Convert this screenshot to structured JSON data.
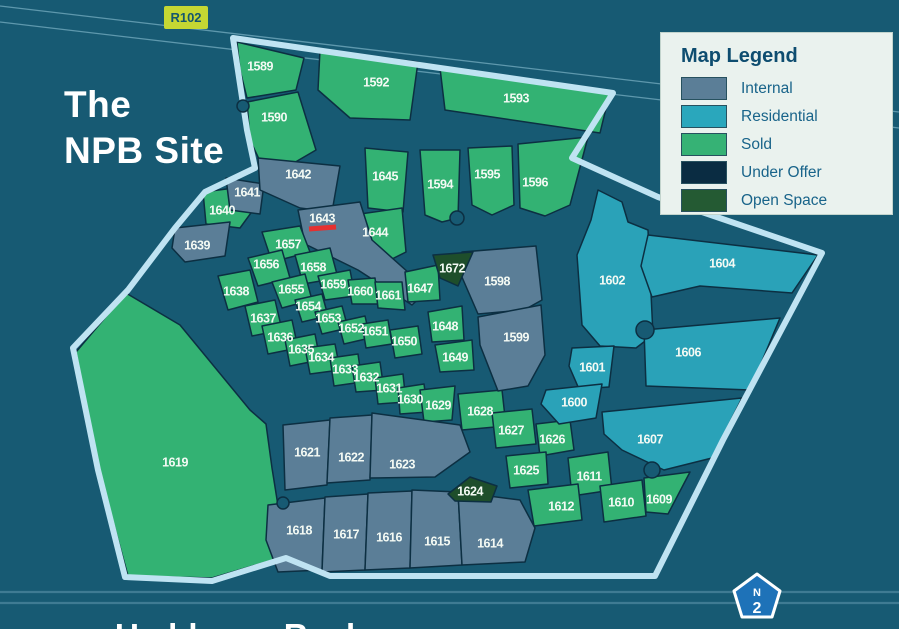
{
  "title": {
    "line1": "The",
    "line2": "NPB Site"
  },
  "badges": {
    "r102": "R102",
    "n2_letter": "N",
    "n2_number": "2"
  },
  "legend": {
    "title": "Map Legend",
    "items": [
      {
        "label": "Internal",
        "status": "internal",
        "color": "#5b7e97"
      },
      {
        "label": "Residential",
        "status": "residential",
        "color": "#2aa7bc"
      },
      {
        "label": "Sold",
        "status": "sold",
        "color": "#36b275"
      },
      {
        "label": "Under Offer",
        "status": "under_offer",
        "color": "#0a2c42"
      },
      {
        "label": "Open Space",
        "status": "open_space",
        "color": "#245a33"
      }
    ]
  },
  "bottom_partial_label": "Umhlanga Rocks",
  "colors": {
    "background": "#175a73",
    "plot_outline": "#0c2f42",
    "boundary": "#bfe3f2",
    "label_text": "#f4faf4",
    "thin_road_line": "#5e98ad",
    "highway_line": "#3f7b93",
    "red_marker": "#e53030",
    "legend_bg": "#eaf2ee",
    "r102_bg": "#c5d733",
    "r102_text": "#14566e",
    "n2_fill": "#1e72b8"
  },
  "status_colors": {
    "internal": "#5b7e97",
    "residential": "#2aa2b8",
    "sold": "#33b273",
    "under_offer": "#0a2c42",
    "open_space": "#1e4e2b"
  },
  "map": {
    "boundary_points": "233,38 613,93 572,158 658,197 822,253 723,440 655,576 330,576 286,558 212,581 125,577 98,470 73,348 128,290 175,228 205,192 255,168 247,130",
    "diagonal_road_lines": [
      [
        0,
        6,
        899,
        112
      ],
      [
        0,
        22,
        899,
        128
      ]
    ],
    "highway_lines": [
      [
        0,
        592,
        899,
        592
      ],
      [
        0,
        603,
        899,
        603
      ]
    ],
    "cul_de_sacs": [
      [
        243,
        106,
        6
      ],
      [
        457,
        218,
        7
      ],
      [
        645,
        330,
        9
      ],
      [
        652,
        470,
        8
      ],
      [
        283,
        503,
        6
      ]
    ],
    "red_marker": {
      "x1": 309,
      "y1": 229,
      "x2": 336,
      "y2": 227
    },
    "plots": [
      {
        "id": "1589",
        "status": "sold",
        "points": "237,42 304,58 296,90 247,98 240,70",
        "lx": 260,
        "ly": 66
      },
      {
        "id": "1590",
        "status": "sold",
        "points": "247,102 298,92 316,150 268,178 250,140",
        "lx": 274,
        "ly": 117
      },
      {
        "id": "1592",
        "status": "sold",
        "points": "320,50 418,62 410,120 350,118 318,90",
        "lx": 376,
        "ly": 82
      },
      {
        "id": "1593",
        "status": "sold",
        "points": "440,68 610,92 600,133 445,110",
        "lx": 516,
        "ly": 98
      },
      {
        "id": "1594",
        "status": "sold",
        "points": "420,150 460,150 458,218 442,222 425,215",
        "lx": 440,
        "ly": 184
      },
      {
        "id": "1595",
        "status": "sold",
        "points": "468,148 512,146 514,205 492,215 472,205",
        "lx": 487,
        "ly": 174
      },
      {
        "id": "1596",
        "status": "sold",
        "points": "518,144 588,137 570,205 545,216 520,208",
        "lx": 535,
        "ly": 182
      },
      {
        "id": "1645",
        "status": "sold",
        "points": "365,148 408,152 403,212 368,208",
        "lx": 385,
        "ly": 176
      },
      {
        "id": "1644",
        "status": "sold",
        "points": "360,214 402,208 406,252 386,262 362,250",
        "lx": 375,
        "ly": 232
      },
      {
        "id": "1640",
        "status": "sold",
        "points": "203,192 250,186 256,206 240,228 206,224",
        "lx": 222,
        "ly": 210
      },
      {
        "id": "1641",
        "status": "internal",
        "points": "226,178 264,184 260,214 230,210",
        "lx": 247,
        "ly": 192
      },
      {
        "id": "1642",
        "status": "internal",
        "points": "258,158 340,166 332,212 300,208 260,190",
        "lx": 298,
        "ly": 174
      },
      {
        "id": "1643",
        "status": "internal",
        "points": "298,210 360,202 372,240 428,290 412,305 358,270 305,244",
        "lx": 322,
        "ly": 218
      },
      {
        "id": "1639",
        "status": "internal",
        "points": "175,228 230,222 225,256 185,262 172,248",
        "lx": 197,
        "ly": 245
      },
      {
        "id": "1657",
        "status": "sold",
        "points": "262,232 300,226 310,252 272,262",
        "lx": 288,
        "ly": 244
      },
      {
        "id": "1656",
        "status": "sold",
        "points": "248,258 282,250 290,278 258,286",
        "lx": 266,
        "ly": 264
      },
      {
        "id": "1658",
        "status": "sold",
        "points": "295,255 330,248 338,278 303,284",
        "lx": 313,
        "ly": 267
      },
      {
        "id": "1655",
        "status": "sold",
        "points": "272,282 305,274 312,300 282,308",
        "lx": 291,
        "ly": 289
      },
      {
        "id": "1659",
        "status": "sold",
        "points": "318,276 350,270 355,296 325,300",
        "lx": 333,
        "ly": 284
      },
      {
        "id": "1660",
        "status": "sold",
        "points": "348,280 375,278 378,304 352,304",
        "lx": 360,
        "ly": 291
      },
      {
        "id": "1661",
        "status": "sold",
        "points": "375,282 402,282 405,310 378,308",
        "lx": 388,
        "ly": 295
      },
      {
        "id": "1647",
        "status": "sold",
        "points": "405,272 438,265 440,300 408,302",
        "lx": 420,
        "ly": 288
      },
      {
        "id": "1654",
        "status": "sold",
        "points": "295,300 322,294 328,316 302,322",
        "lx": 308,
        "ly": 306
      },
      {
        "id": "1653",
        "status": "sold",
        "points": "315,312 342,306 348,328 322,334",
        "lx": 328,
        "ly": 318
      },
      {
        "id": "1652",
        "status": "sold",
        "points": "338,322 365,316 370,338 344,344",
        "lx": 351,
        "ly": 328
      },
      {
        "id": "1651",
        "status": "sold",
        "points": "362,324 388,320 392,344 366,348",
        "lx": 375,
        "ly": 331
      },
      {
        "id": "1650",
        "status": "sold",
        "points": "390,330 418,326 422,354 395,358",
        "lx": 404,
        "ly": 341
      },
      {
        "id": "1648",
        "status": "sold",
        "points": "428,312 462,306 464,340 432,342",
        "lx": 445,
        "ly": 326
      },
      {
        "id": "1649",
        "status": "sold",
        "points": "435,345 472,340 474,370 440,372",
        "lx": 455,
        "ly": 357
      },
      {
        "id": "1638",
        "status": "sold",
        "points": "218,276 250,270 258,302 228,310",
        "lx": 236,
        "ly": 291
      },
      {
        "id": "1637",
        "status": "sold",
        "points": "245,306 275,300 282,330 252,336",
        "lx": 263,
        "ly": 318
      },
      {
        "id": "1636",
        "status": "sold",
        "points": "262,326 292,320 298,348 268,354",
        "lx": 280,
        "ly": 337
      },
      {
        "id": "1635",
        "status": "sold",
        "points": "285,340 315,334 320,360 290,366",
        "lx": 301,
        "ly": 349
      },
      {
        "id": "1634",
        "status": "sold",
        "points": "305,348 335,344 340,370 310,374",
        "lx": 321,
        "ly": 357
      },
      {
        "id": "1633",
        "status": "sold",
        "points": "330,358 358,354 362,382 334,386",
        "lx": 345,
        "ly": 369
      },
      {
        "id": "1632",
        "status": "sold",
        "points": "352,366 380,362 384,390 356,392",
        "lx": 366,
        "ly": 377
      },
      {
        "id": "1631",
        "status": "sold",
        "points": "375,378 403,374 406,402 378,404",
        "lx": 389,
        "ly": 388
      },
      {
        "id": "1630",
        "status": "sold",
        "points": "398,388 424,384 428,412 400,414",
        "lx": 410,
        "ly": 399
      },
      {
        "id": "1629",
        "status": "sold",
        "points": "420,390 455,386 452,420 424,422",
        "lx": 438,
        "ly": 405
      },
      {
        "id": "1628",
        "status": "sold",
        "points": "458,394 502,390 506,426 462,430",
        "lx": 480,
        "ly": 411
      },
      {
        "id": "1627",
        "status": "sold",
        "points": "492,413 532,409 536,444 496,448",
        "lx": 511,
        "ly": 430
      },
      {
        "id": "1626",
        "status": "sold",
        "points": "536,424 570,420 574,450 540,456",
        "lx": 552,
        "ly": 439
      },
      {
        "id": "1625",
        "status": "sold",
        "points": "506,456 546,452 548,484 510,488",
        "lx": 526,
        "ly": 470
      },
      {
        "id": "1611",
        "status": "sold",
        "points": "568,458 608,452 612,490 572,496",
        "lx": 589,
        "ly": 476
      },
      {
        "id": "1612",
        "status": "sold",
        "points": "528,490 578,484 582,520 534,526",
        "lx": 561,
        "ly": 506
      },
      {
        "id": "1610",
        "status": "sold",
        "points": "600,486 642,480 646,516 604,522",
        "lx": 621,
        "ly": 502
      },
      {
        "id": "1609",
        "status": "sold",
        "points": "644,478 690,472 668,514 646,512",
        "lx": 659,
        "ly": 499
      },
      {
        "id": "1619",
        "status": "sold",
        "points": "76,352 126,293 180,325 250,410 266,424 272,468 286,556 212,578 128,576 99,470",
        "lx": 175,
        "ly": 462
      },
      {
        "id": "1598",
        "status": "internal",
        "points": "462,252 536,246 542,300 524,310 478,314 458,268",
        "lx": 497,
        "ly": 281
      },
      {
        "id": "1599",
        "status": "internal",
        "points": "478,317 541,305 545,355 528,386 498,391 480,345",
        "lx": 516,
        "ly": 337
      },
      {
        "id": "1621",
        "status": "internal",
        "points": "283,425 330,420 327,485 285,490",
        "lx": 307,
        "ly": 452
      },
      {
        "id": "1622",
        "status": "internal",
        "points": "330,418 372,415 370,480 327,483",
        "lx": 351,
        "ly": 457
      },
      {
        "id": "1623",
        "status": "internal",
        "points": "372,413 460,425 470,452 435,477 370,478",
        "lx": 402,
        "ly": 464
      },
      {
        "id": "1618",
        "status": "internal",
        "points": "268,505 325,498 322,570 278,572 266,540",
        "lx": 299,
        "ly": 530
      },
      {
        "id": "1617",
        "status": "internal",
        "points": "325,497 368,494 365,570 322,572",
        "lx": 346,
        "ly": 534
      },
      {
        "id": "1616",
        "status": "internal",
        "points": "368,493 412,491 410,568 365,570",
        "lx": 389,
        "ly": 537
      },
      {
        "id": "1615",
        "status": "internal",
        "points": "412,490 458,492 462,565 410,568",
        "lx": 437,
        "ly": 541
      },
      {
        "id": "1614",
        "status": "internal",
        "points": "458,492 520,500 535,528 525,562 462,565",
        "lx": 490,
        "ly": 543
      },
      {
        "id": "1602",
        "status": "residential",
        "points": "598,190 622,202 628,222 648,230 653,335 636,348 600,346 582,325 577,255 591,220",
        "lx": 612,
        "ly": 280
      },
      {
        "id": "1601",
        "status": "residential",
        "points": "572,348 614,346 609,387 579,389 569,366",
        "lx": 592,
        "ly": 367
      },
      {
        "id": "1600",
        "status": "residential",
        "points": "546,390 602,384 596,418 559,424 541,404",
        "lx": 574,
        "ly": 402
      },
      {
        "id": "1604",
        "status": "residential",
        "points": "648,235 818,255 792,293 700,286 652,297 641,266",
        "lx": 722,
        "ly": 263
      },
      {
        "id": "1606",
        "status": "residential",
        "points": "644,330 780,318 750,390 646,386",
        "lx": 688,
        "ly": 352
      },
      {
        "id": "1607",
        "status": "residential",
        "points": "602,412 742,398 712,458 664,470 622,450 604,434",
        "lx": 650,
        "ly": 439
      },
      {
        "id": "1672",
        "status": "open_space",
        "points": "433,255 473,252 458,286 440,278",
        "lx": 452,
        "ly": 268
      },
      {
        "id": "1624",
        "status": "open_space",
        "points": "448,494 470,477 497,486 491,502 455,501",
        "lx": 470,
        "ly": 491
      }
    ]
  }
}
